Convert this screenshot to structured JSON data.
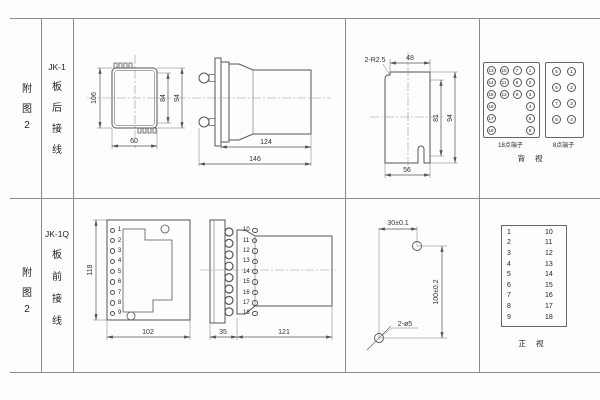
{
  "row1": {
    "fig": [
      "附",
      "图",
      "2"
    ],
    "model": "JK-1",
    "wiring": [
      "板",
      "后",
      "接",
      "线"
    ],
    "front": {
      "h": "106",
      "inner": "84",
      "outer": "94",
      "w": "60"
    },
    "side": {
      "body": "124",
      "total": "146"
    },
    "cutout": {
      "corner": "2-R2.5",
      "top": "48",
      "inner": "81",
      "outer": "94",
      "bottom": "56"
    },
    "t18": {
      "label": "18点端子",
      "col1": [
        "13",
        "14",
        "15",
        "16",
        "17",
        "18"
      ],
      "col2": [
        "10",
        "11",
        "12"
      ],
      "col3": [
        "7",
        "8",
        "9"
      ],
      "col4": [
        "1",
        "2",
        "3",
        "4",
        "5",
        "6"
      ]
    },
    "t8": {
      "label": "8点端子",
      "left": [
        "5",
        "6",
        "7",
        "8"
      ],
      "right": [
        "1",
        "2",
        "3",
        "4"
      ]
    },
    "view": "背 视"
  },
  "row2": {
    "fig": [
      "附",
      "图",
      "2"
    ],
    "model": "JK-1Q",
    "wiring": [
      "板",
      "前",
      "接",
      "线"
    ],
    "front": {
      "h": "118",
      "w": "102",
      "left": [
        "1",
        "2",
        "3",
        "4",
        "5",
        "6",
        "7",
        "8",
        "9"
      ],
      "right": [
        "10",
        "11",
        "12",
        "13",
        "14",
        "15",
        "16",
        "17",
        "18"
      ]
    },
    "side": {
      "flange": "35",
      "body": "121"
    },
    "drill": {
      "horiz": "30±0.1",
      "vert": "100±0.2",
      "holes": "2-ø5"
    },
    "ttable": {
      "left": [
        "1",
        "2",
        "3",
        "4",
        "5",
        "6",
        "7",
        "8",
        "9"
      ],
      "right": [
        "10",
        "11",
        "12",
        "13",
        "14",
        "15",
        "16",
        "17",
        "18"
      ]
    },
    "view": "正 视"
  }
}
